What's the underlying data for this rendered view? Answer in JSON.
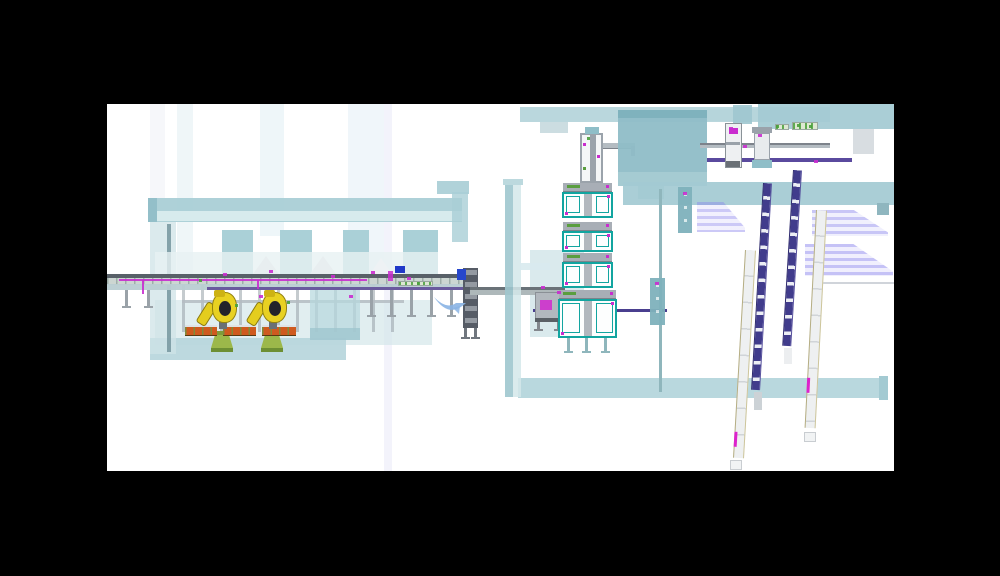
{
  "frame": {
    "w": 1000,
    "h": 576,
    "bg": "#000000"
  },
  "viewport": {
    "x": 107,
    "y": 104,
    "w": 787,
    "h": 367,
    "bg": "#ffffff"
  },
  "palette": {
    "teal": "#a9ced6",
    "teal_dark": "#8fbdc7",
    "teal_light": "#d4e7ea",
    "magenta": "#c92ccf",
    "purple": "#4a3f8f",
    "robot_yellow": "#e8d122",
    "pedestal_green": "#9cb84a",
    "rack_orange": "#cf5a1f",
    "steel_gray": "#9aa2a8",
    "station_teal": "#12a5a0",
    "shadow_lavender": "#8a84ec",
    "swoosh_blue": "#8ab4e4",
    "blue_unit": "#2747cc"
  },
  "scene": {
    "shapes": [
      {
        "t": "rect",
        "n": "bg-stripe-1",
        "x": 43,
        "y": 0,
        "w": 15,
        "h": 100,
        "f": "#f6f7fa"
      },
      {
        "t": "rect",
        "n": "bg-stripe-2",
        "x": 70,
        "y": 0,
        "w": 16,
        "h": 170,
        "f": "#eff6f8"
      },
      {
        "t": "rect",
        "n": "bg-stripe-3",
        "x": 153,
        "y": 0,
        "w": 24,
        "h": 132,
        "f": "#eef6f9"
      },
      {
        "t": "rect",
        "n": "bg-stripe-4",
        "x": 241,
        "y": 0,
        "w": 36,
        "h": 178,
        "f": "#f0f6fa"
      },
      {
        "t": "rect",
        "n": "bg-stripe-5",
        "x": 277,
        "y": 0,
        "w": 8,
        "h": 367,
        "f": "#f3f3fb"
      },
      {
        "t": "rect",
        "n": "floor-slab-left",
        "x": 48,
        "y": 196,
        "w": 277,
        "h": 45,
        "f": "#cfe3e7",
        "o": 0.62
      },
      {
        "t": "rect",
        "n": "floor-slab-left-front",
        "x": 43,
        "y": 234,
        "w": 196,
        "h": 22,
        "f": "#b7d6dc",
        "o": 0.92
      },
      {
        "t": "rect",
        "n": "gantry-beam",
        "x": 41,
        "y": 94,
        "w": 314,
        "h": 24,
        "f": "#a9ced6",
        "o": 0.94
      },
      {
        "t": "rect",
        "n": "gantry-beam-inner",
        "x": 49,
        "y": 107,
        "w": 306,
        "h": 10,
        "f": "#dcedef",
        "o": 0.9
      },
      {
        "t": "rect",
        "n": "gantry-beam-cap",
        "x": 41,
        "y": 94,
        "w": 9,
        "h": 24,
        "f": "#93bfc9"
      },
      {
        "t": "rect",
        "n": "gantry-step-beam",
        "x": 330,
        "y": 77,
        "w": 32,
        "h": 13,
        "f": "#a9ced6",
        "o": 0.92
      },
      {
        "t": "rect",
        "n": "gantry-step-column",
        "x": 345,
        "y": 88,
        "w": 16,
        "h": 50,
        "f": "#a9ced6",
        "o": 0.8
      },
      {
        "t": "rect",
        "n": "gantry-left-column",
        "x": 43,
        "y": 118,
        "w": 26,
        "h": 132,
        "f": "#cfe3e7",
        "o": 0.75
      },
      {
        "t": "rect",
        "n": "gantry-left-column-post",
        "x": 60,
        "y": 120,
        "w": 4,
        "h": 128,
        "f": "#7a9aa2",
        "o": 0.9
      },
      {
        "t": "rect",
        "n": "gantry-column-1",
        "x": 115,
        "y": 126,
        "w": 31,
        "h": 46,
        "f": "#a5cdd5",
        "o": 0.95
      },
      {
        "t": "rect",
        "n": "gantry-column-2",
        "x": 173,
        "y": 126,
        "w": 32,
        "h": 46,
        "f": "#a5cdd5",
        "o": 0.95
      },
      {
        "t": "rect",
        "n": "gantry-column-3",
        "x": 236,
        "y": 126,
        "w": 26,
        "h": 46,
        "f": "#a5cdd5",
        "o": 0.95
      },
      {
        "t": "rect",
        "n": "gantry-column-4",
        "x": 296,
        "y": 126,
        "w": 35,
        "h": 46,
        "f": "#a5cdd5",
        "o": 0.95
      },
      {
        "t": "rect",
        "n": "gantry-floor-wash",
        "x": 48,
        "y": 148,
        "w": 283,
        "h": 23,
        "f": "#e7f1f3",
        "o": 0.8
      },
      {
        "t": "tri",
        "n": "roof-shadow-1",
        "x": 146,
        "y": 152,
        "w": 26,
        "h": 18,
        "f": "#e8eef0"
      },
      {
        "t": "tri",
        "n": "roof-shadow-2",
        "x": 203,
        "y": 152,
        "w": 26,
        "h": 18,
        "f": "#e8eef0"
      },
      {
        "t": "tri",
        "n": "roof-shadow-3",
        "x": 263,
        "y": 154,
        "w": 22,
        "h": 16,
        "f": "#eef2f4"
      },
      {
        "t": "rect",
        "n": "enclosure-mid",
        "x": 423,
        "y": 146,
        "w": 54,
        "h": 87,
        "f": "#b5d5db",
        "o": 0.5
      },
      {
        "t": "rect",
        "n": "cell-steel-frame",
        "x": 75,
        "y": 172,
        "w": 222,
        "h": 56,
        "cls": "steelframe",
        "o": 0.9
      },
      {
        "t": "rect",
        "n": "cell-frame-beam",
        "x": 75,
        "y": 196,
        "w": 222,
        "h": 3,
        "f": "#b4bcc2",
        "o": 0.85
      },
      {
        "t": "rect",
        "n": "cell-enclosure",
        "x": 203,
        "y": 174,
        "w": 50,
        "h": 62,
        "f": "#b7d8de",
        "o": 0.72
      },
      {
        "t": "rect",
        "n": "cell-enclosure-edge",
        "x": 203,
        "y": 224,
        "w": 50,
        "h": 12,
        "f": "#9fc6ce",
        "o": 0.8
      },
      {
        "t": "legs",
        "n": "conveyor-leg",
        "xs": [
          18,
          40
        ],
        "y": 186,
        "h": 16
      },
      {
        "t": "legs",
        "n": "conveyor-leg",
        "xs": [
          263,
          283,
          303,
          323,
          343
        ],
        "y": 186,
        "h": 25
      },
      {
        "t": "rect",
        "n": "main-conveyor-rail",
        "x": 0,
        "y": 170,
        "w": 363,
        "h": 3.5,
        "f": "#586068"
      },
      {
        "t": "rect",
        "n": "main-conveyor-belt",
        "x": 0,
        "y": 173.5,
        "w": 363,
        "h": 7,
        "cls": "belt"
      },
      {
        "t": "rect",
        "n": "main-conveyor-frame",
        "x": 0,
        "y": 180,
        "w": 363,
        "h": 6,
        "f": "#b9cdd2",
        "o": 0.95
      },
      {
        "t": "rect",
        "n": "cable-tray-purple",
        "x": 100,
        "y": 183,
        "w": 263,
        "h": 2.5,
        "f": "#6a5a9e"
      },
      {
        "t": "rect",
        "n": "cable-magenta",
        "x": 12,
        "y": 175,
        "w": 248,
        "h": 1.5,
        "f": "#c92ccf",
        "o": 0.9
      },
      {
        "t": "rect",
        "n": "cable-magenta-drop",
        "x": 35,
        "y": 176,
        "w": 1.5,
        "h": 14,
        "f": "#c92ccf",
        "o": 0.9
      },
      {
        "t": "rect",
        "n": "cable-magenta-drop",
        "x": 150,
        "y": 176,
        "w": 1.5,
        "h": 9,
        "f": "#c92ccf",
        "o": 0.9
      },
      {
        "t": "ped",
        "n": "robot-pedestal-1",
        "x": 104,
        "y": 227
      },
      {
        "t": "ped",
        "n": "robot-pedestal-2",
        "x": 154,
        "y": 227
      },
      {
        "t": "rack",
        "n": "pallet-rack-1",
        "x": 78,
        "y": 221,
        "w": 32,
        "h": 11
      },
      {
        "t": "rack",
        "n": "pallet-rack-2",
        "x": 116,
        "y": 221,
        "w": 33,
        "h": 11
      },
      {
        "t": "rack",
        "n": "pallet-rack-3",
        "x": 155,
        "y": 221,
        "w": 34,
        "h": 11
      },
      {
        "t": "robot",
        "n": "robot-1",
        "x": 98,
        "y": 188
      },
      {
        "t": "robot",
        "n": "robot-2",
        "x": 148,
        "y": 188
      },
      {
        "t": "rect",
        "n": "control-tower",
        "x": 356,
        "y": 164,
        "w": 15,
        "h": 60,
        "f": "#565c66"
      },
      {
        "t": "rect",
        "n": "control-tower-slats",
        "x": 357.5,
        "y": 166,
        "w": 12,
        "h": 56,
        "cls": "towerslats"
      },
      {
        "t": "rect",
        "n": "control-tower-blue-box",
        "x": 350,
        "y": 165,
        "w": 9,
        "h": 11,
        "f": "#2747cc"
      },
      {
        "t": "legs",
        "n": "tower-leg",
        "xs": [
          357,
          367
        ],
        "y": 224,
        "h": 9,
        "f": "#70767e"
      },
      {
        "t": "rect",
        "n": "conveyor2-rail",
        "x": 363,
        "y": 183,
        "w": 95,
        "h": 2.5,
        "f": "#6a7278"
      },
      {
        "t": "rect",
        "n": "conveyor2-frame",
        "x": 363,
        "y": 185.5,
        "w": 95,
        "h": 5,
        "f": "#aeb8ba"
      },
      {
        "t": "rect",
        "n": "cable-tray-purple-2",
        "x": 426,
        "y": 205,
        "w": 134,
        "h": 3,
        "f": "#4a3f8f"
      },
      {
        "t": "rect",
        "n": "transfer-greenbar",
        "x": 291,
        "y": 177,
        "w": 35,
        "h": 5,
        "cls": "greenbar"
      },
      {
        "t": "rect",
        "n": "blue-unit",
        "x": 288,
        "y": 162,
        "w": 10,
        "h": 7,
        "f": "#2038c8"
      },
      {
        "t": "rect",
        "n": "magenta-unit",
        "x": 281,
        "y": 167,
        "w": 5,
        "h": 10,
        "f": "#c92ccf",
        "o": 0.85
      },
      {
        "t": "swoosh",
        "n": "swoosh-mark",
        "x": 326,
        "y": 190,
        "w": 34,
        "h": 22
      },
      {
        "t": "rect",
        "n": "mid-machine",
        "x": 428,
        "y": 188,
        "w": 27,
        "h": 30,
        "f": "#b2b8be",
        "b": "1px solid #8a9096"
      },
      {
        "t": "rect",
        "n": "mid-machine-panel",
        "x": 433,
        "y": 196,
        "w": 12,
        "h": 10,
        "f": "#cc3fcc"
      },
      {
        "t": "rect",
        "n": "mid-machine-base",
        "x": 428,
        "y": 214,
        "w": 27,
        "h": 4,
        "f": "#5a6066"
      },
      {
        "t": "legs",
        "n": "machine-leg",
        "xs": [
          430,
          450
        ],
        "y": 218,
        "h": 7,
        "f": "#84888e"
      },
      {
        "t": "rect",
        "n": "bottom-enclosure-band",
        "x": 411,
        "y": 274,
        "w": 370,
        "h": 20,
        "f": "#b5d6dc",
        "o": 0.95
      },
      {
        "t": "rect",
        "n": "bottom-band-cap",
        "x": 772,
        "y": 272,
        "w": 9,
        "h": 24,
        "f": "#a3cad2"
      },
      {
        "t": "rect",
        "n": "glass-wall-outer",
        "x": 398,
        "y": 75,
        "w": 8,
        "h": 218,
        "f": "#9fc6ce",
        "o": 0.9
      },
      {
        "t": "rect",
        "n": "glass-wall-inner",
        "x": 406,
        "y": 75,
        "w": 8,
        "h": 218,
        "f": "#d4e7ea",
        "o": 0.85
      },
      {
        "t": "rect",
        "n": "glass-wall-cap",
        "x": 396,
        "y": 75,
        "w": 20,
        "h": 6,
        "f": "#bcd9de"
      },
      {
        "t": "rect",
        "n": "wall-connector",
        "x": 413,
        "y": 159,
        "w": 30,
        "h": 7,
        "f": "#d8eaee",
        "o": 0.9
      },
      {
        "t": "tower",
        "n": "lift-tower",
        "x": 473,
        "y": 29,
        "w": 23,
        "h": 50
      },
      {
        "t": "rect",
        "n": "lift-tower-cap",
        "x": 478,
        "y": 23,
        "w": 14,
        "h": 7,
        "f": "#8fbec8"
      },
      {
        "t": "arm",
        "n": "lift-tower-arm",
        "x": 496,
        "y": 39,
        "w": 32,
        "h": 6
      },
      {
        "t": "station",
        "n": "station-1",
        "x": 455,
        "y": 79,
        "w": 51,
        "h": 35
      },
      {
        "t": "station",
        "n": "station-2",
        "x": 455,
        "y": 118,
        "w": 51,
        "h": 30
      },
      {
        "t": "station",
        "n": "station-3",
        "x": 455,
        "y": 149,
        "w": 51,
        "h": 35
      },
      {
        "t": "station",
        "n": "station-4",
        "x": 451,
        "y": 186,
        "w": 59,
        "h": 48
      },
      {
        "t": "legs",
        "n": "stack-leg",
        "xs": [
          460,
          478,
          497
        ],
        "y": 234,
        "h": 13,
        "f": "#8fb6bc"
      },
      {
        "t": "rect",
        "n": "roof-band-1",
        "x": 413,
        "y": 3,
        "w": 310,
        "h": 15,
        "f": "#aed0d7",
        "o": 0.85
      },
      {
        "t": "rect",
        "n": "roof-gray-box",
        "x": 433,
        "y": 18,
        "w": 28,
        "h": 11,
        "f": "#ccdde1"
      },
      {
        "t": "rect",
        "n": "big-enclosure",
        "x": 511,
        "y": 6,
        "w": 89,
        "h": 76,
        "f": "#8fbdc7",
        "o": 0.95
      },
      {
        "t": "rect",
        "n": "big-enclosure-top",
        "x": 511,
        "y": 6,
        "w": 89,
        "h": 8,
        "f": "#7fb2bd"
      },
      {
        "t": "rect",
        "n": "big-enclosure-base",
        "x": 511,
        "y": 68,
        "w": 89,
        "h": 14,
        "f": "#a5cbd2"
      },
      {
        "t": "rect",
        "n": "big-enclosure-notch",
        "x": 531,
        "y": 82,
        "w": 26,
        "h": 13,
        "f": "#a5ccd3",
        "o": 0.9
      },
      {
        "t": "rect",
        "n": "roof-band-2",
        "x": 651,
        "y": 0,
        "w": 136,
        "h": 25,
        "f": "#a3cad2",
        "o": 0.92
      },
      {
        "t": "rect",
        "n": "roof-band-2-ext",
        "x": 600,
        "y": 5,
        "w": 51,
        "h": 12,
        "f": "#b5d5db",
        "o": 0.8
      },
      {
        "t": "rect",
        "n": "roof-gray-stub",
        "x": 746,
        "y": 25,
        "w": 21,
        "h": 25,
        "f": "#d8dde1"
      },
      {
        "t": "rect",
        "n": "upper-band-3",
        "x": 516,
        "y": 78,
        "w": 271,
        "h": 23,
        "f": "#a3cad2",
        "o": 0.92
      },
      {
        "t": "rect",
        "n": "upper-band-3-tab",
        "x": 770,
        "y": 99,
        "w": 12,
        "h": 12,
        "f": "#8fb6bf"
      },
      {
        "t": "rect",
        "n": "roof-teal-block",
        "x": 626,
        "y": 1,
        "w": 19,
        "h": 19,
        "f": "#9ec7cf",
        "o": 0.9
      },
      {
        "t": "rect",
        "n": "tr-rail",
        "x": 593,
        "y": 39,
        "w": 130,
        "h": 5,
        "f": "#b4bcc2"
      },
      {
        "t": "rect",
        "n": "tr-rail-edge",
        "x": 593,
        "y": 39,
        "w": 130,
        "h": 1.5,
        "f": "#7d838b"
      },
      {
        "t": "rect",
        "n": "tr-cable-purple",
        "x": 600,
        "y": 54,
        "w": 145,
        "h": 3.5,
        "f": "#5a4a9e"
      },
      {
        "t": "machA",
        "n": "tr-machine-1",
        "x": 618,
        "y": 19,
        "w": 17,
        "h": 45
      },
      {
        "t": "machB",
        "n": "tr-machine-2",
        "x": 645,
        "y": 23,
        "w": 20,
        "h": 41
      },
      {
        "t": "rect",
        "n": "tr-greenbar-1",
        "x": 668,
        "y": 20,
        "w": 14,
        "h": 6,
        "cls": "greenbar"
      },
      {
        "t": "rect",
        "n": "tr-greenbar-2",
        "x": 685,
        "y": 18,
        "w": 26,
        "h": 8,
        "cls": "greenbar"
      },
      {
        "t": "shadow",
        "n": "shadow-stripe-1",
        "x": 590,
        "y": 98,
        "w": 48,
        "h": 30,
        "o": 0.8
      },
      {
        "t": "shadow",
        "n": "shadow-stripe-2",
        "x": 705,
        "y": 106,
        "w": 76,
        "h": 26,
        "o": 0.85
      },
      {
        "t": "shadow",
        "n": "shadow-stripe-3",
        "x": 698,
        "y": 140,
        "w": 88,
        "h": 32,
        "o": 0.9
      },
      {
        "t": "rect",
        "n": "faint-rail-line",
        "x": 713,
        "y": 178,
        "w": 74,
        "h": 1.5,
        "f": "#d0d4da"
      },
      {
        "t": "rect",
        "n": "support-post",
        "x": 552,
        "y": 85,
        "w": 2.5,
        "h": 203,
        "f": "#8fb6bc"
      },
      {
        "t": "tealbox",
        "n": "wall-box-upper",
        "x": 571,
        "y": 83,
        "w": 14,
        "h": 46
      },
      {
        "t": "tealbox",
        "n": "wall-box-lower",
        "x": 543,
        "y": 174,
        "w": 15,
        "h": 47
      },
      {
        "t": "strip",
        "n": "buffer-lane-1",
        "x": 638,
        "y": 146,
        "len": 208,
        "w": 11,
        "a": 3.3,
        "k": "white",
        "mag": 182
      },
      {
        "t": "rect",
        "n": "buffer-lane-1-end",
        "x": 623,
        "y": 356,
        "w": 12,
        "h": 10,
        "f": "#f1f3f4",
        "b": "1px solid #c9cdd1"
      },
      {
        "t": "strip",
        "n": "chain-conveyor-1",
        "x": 656,
        "y": 79,
        "len": 207,
        "w": 9,
        "a": 3.3,
        "k": "purple"
      },
      {
        "t": "rect",
        "n": "chain-conveyor-1-tail",
        "x": 647,
        "y": 288,
        "w": 8,
        "h": 18,
        "f": "#ccd2d6"
      },
      {
        "t": "strip",
        "n": "chain-conveyor-2",
        "x": 686,
        "y": 66,
        "len": 176,
        "w": 9,
        "a": 3.5,
        "k": "purple"
      },
      {
        "t": "rect",
        "n": "chain-conveyor-2-tail",
        "x": 677,
        "y": 244,
        "w": 8,
        "h": 16,
        "f": "#eceef0"
      },
      {
        "t": "strip",
        "n": "buffer-lane-2",
        "x": 709,
        "y": 106,
        "len": 218,
        "w": 11,
        "a": 3.0,
        "k": "white",
        "mag": 168
      },
      {
        "t": "rect",
        "n": "buffer-lane-2-end",
        "x": 697,
        "y": 328,
        "w": 12,
        "h": 10,
        "f": "#f1f3f4",
        "b": "1px solid #c9cdd1"
      }
    ],
    "magenta_dots": [
      [
        116,
        169
      ],
      [
        162,
        166
      ],
      [
        224,
        171
      ],
      [
        264,
        167
      ],
      [
        152,
        191
      ],
      [
        242,
        191
      ],
      [
        300,
        173
      ],
      [
        434,
        182
      ],
      [
        450,
        187
      ],
      [
        622,
        23
      ],
      [
        636,
        41
      ],
      [
        651,
        30
      ],
      [
        707,
        56
      ],
      [
        576,
        88
      ],
      [
        548,
        178
      ]
    ],
    "green_dots": [
      [
        128,
        200
      ],
      [
        180,
        197
      ],
      [
        92,
        175
      ],
      [
        310,
        178
      ],
      [
        669,
        21
      ],
      [
        690,
        20
      ],
      [
        702,
        21
      ],
      [
        480,
        33
      ]
    ]
  }
}
